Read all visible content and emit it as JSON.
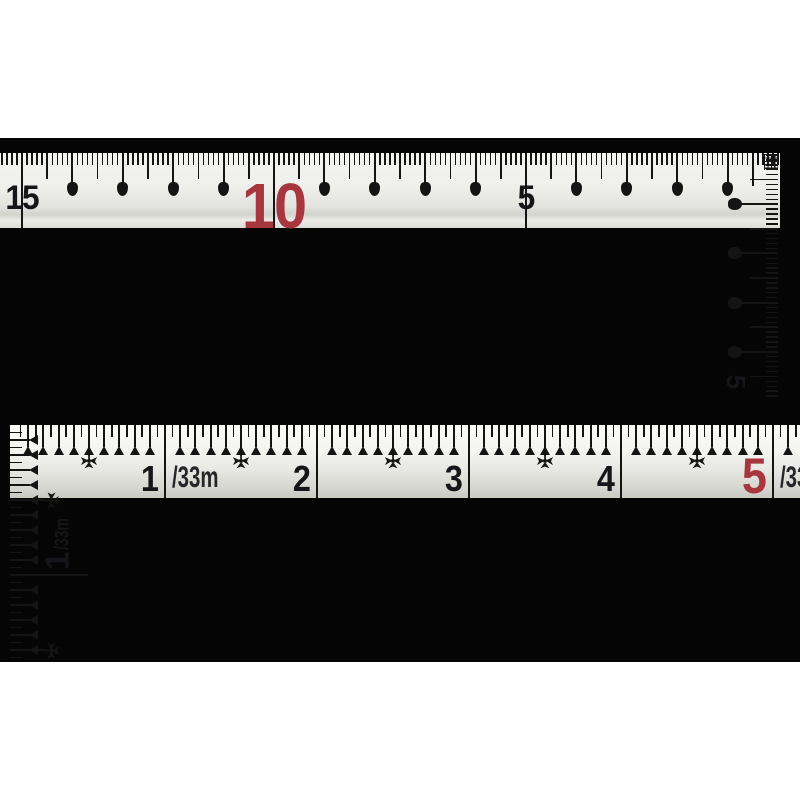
{
  "background": {
    "canvas": "#ffffff",
    "photo_band": "#050505"
  },
  "colors": {
    "tick": "#141414",
    "number_black": "#16161a",
    "number_red": "#a8363e"
  },
  "top_square": {
    "description_labels": [
      "15",
      "10",
      "5"
    ],
    "blade": {
      "zero_x": 778,
      "cm_px": 50.4,
      "mm_count": 154,
      "cm_count": 15,
      "numbers": [
        {
          "label": "15",
          "cm": 15,
          "color": "#16161a",
          "size": 34,
          "top": 28
        },
        {
          "label": "10",
          "cm": 10,
          "color": "#a8363e",
          "size": 64,
          "top": 21
        },
        {
          "label": "5",
          "cm": 5,
          "color": "#16161a",
          "size": 34,
          "top": 28
        }
      ]
    },
    "arm": {
      "zero_y": 2,
      "cm_px": 49.2,
      "mm_count": 50,
      "half_count": 5,
      "cm_drop_count": 4,
      "end_label": "5",
      "end_label_cx": 33,
      "end_label_cy": 229,
      "has_corner_hatch": true,
      "half_cross_on_first": true
    }
  },
  "bottom_square": {
    "blade": {
      "zero_x": 3,
      "unit_px": 152,
      "sub_px": 15.2,
      "sub_count": 51,
      "numbers": [
        {
          "label": "1",
          "unit": 1,
          "color": "#16161a",
          "size": 36,
          "top": 36
        },
        {
          "label": "2",
          "unit": 2,
          "color": "#16161a",
          "size": 36,
          "top": 36
        },
        {
          "label": "3",
          "unit": 3,
          "color": "#16161a",
          "size": 36,
          "top": 36
        },
        {
          "label": "4",
          "unit": 4,
          "color": "#16161a",
          "size": 36,
          "top": 36
        },
        {
          "label": "5",
          "unit": 5,
          "color": "#a8363e",
          "size": 50,
          "top": 26
        }
      ],
      "unit_suffix": {
        "text": "/33m",
        "after_unit": 1,
        "size": 30,
        "top": 38
      },
      "edge_suffix": {
        "text": "/33m",
        "after_unit": 5,
        "size": 30,
        "top": 38
      },
      "crow_halves": [
        0.5,
        1.5,
        2.5,
        3.5,
        4.5
      ]
    },
    "arm": {
      "unit_px": 150,
      "sub_px": 15,
      "sub_count": 15,
      "unit_line_at": 1,
      "crow_ys": [
        75,
        225
      ],
      "side_label": {
        "number": "1",
        "suffix": "/33m",
        "cx": 47,
        "cy": 112
      }
    }
  }
}
